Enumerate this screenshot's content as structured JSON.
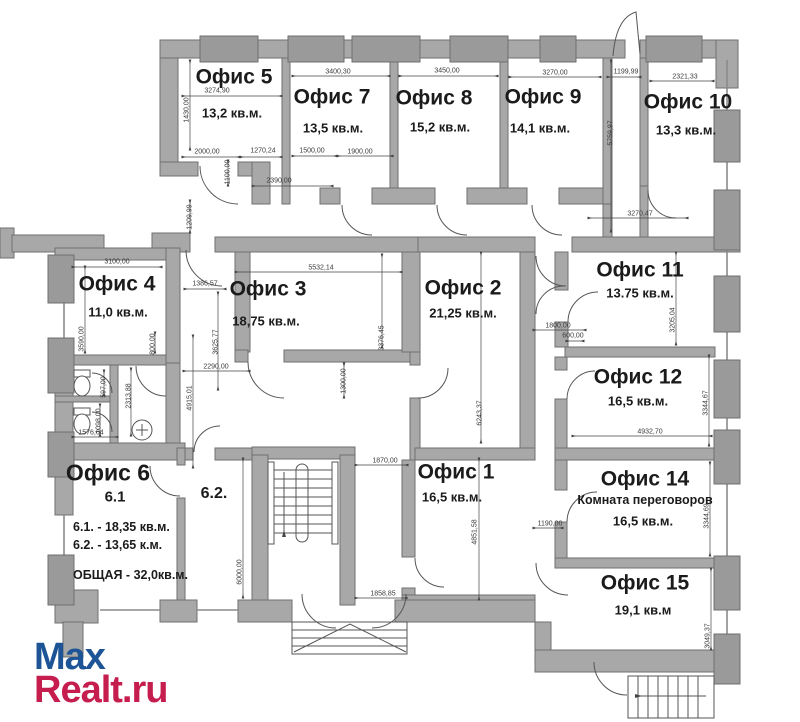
{
  "title": "Office floor plan",
  "watermark": {
    "line1": "Max",
    "line2": "Realt.ru"
  },
  "colors": {
    "wall": "#a8a8a8",
    "wall_outline": "#6f6f6f",
    "pier": "#9a9a9a",
    "line": "#444444",
    "watermark_blue": "#1d5496",
    "watermark_red": "#c51d4e"
  },
  "rooms": [
    {
      "name": "Офис 5",
      "area": "13,2 кв.м."
    },
    {
      "name": "Офис 7",
      "area": "13,5 кв.м."
    },
    {
      "name": "Офис 8",
      "area": "15,2 кв.м."
    },
    {
      "name": "Офис 9",
      "area": "14,1 кв.м."
    },
    {
      "name": "Офис 10",
      "area": "13,3 кв.м."
    },
    {
      "name": "Офис 4",
      "area": "11,0 кв.м."
    },
    {
      "name": "Офис 3",
      "area": "18,75 кв.м."
    },
    {
      "name": "Офис 2",
      "area": "21,25 кв.м."
    },
    {
      "name": "Офис 11",
      "area": "13.75 кв.м."
    },
    {
      "name": "Офис 12",
      "area": "16,5 кв.м."
    },
    {
      "name": "Офис 1",
      "area": "16,5 кв.м."
    },
    {
      "name": "Офис 14",
      "subtitle": "Комната переговоров",
      "area": "16,5 кв.м."
    },
    {
      "name": "Офис 15",
      "area": "19,1 кв.м"
    }
  ],
  "office6": {
    "name": "Офис 6",
    "part1_label": "6.1",
    "part2_label": "6.2.",
    "line1": "6.1. - 18,35 кв.м.",
    "line2": "6.2. - 13,65 к.м.",
    "total": "ОБЩАЯ - 32,0кв.м."
  },
  "dims": [
    "3274,90",
    "1430,00",
    "3400,30",
    "3450,00",
    "3270,00",
    "1199,99",
    "2321,33",
    "2000,00",
    "1270,24",
    "1500,00",
    "1900,00",
    "1100,00",
    "2390,00",
    "1209,99",
    "5759,97",
    "3270,47",
    "3100,00",
    "1386,57",
    "5532,14",
    "3590,00",
    "800,00",
    "3625,77",
    "3376,45",
    "2290,00",
    "4915,01",
    "1300,00",
    "6243,37",
    "597,00",
    "2313,88",
    "1098,00",
    "1576,64",
    "1800,00",
    "600,00",
    "3205,04",
    "4932,70",
    "3344,67",
    "1870,00",
    "4851,58",
    "1190,00",
    "3344,69",
    "6000,00",
    "1858,85",
    "3049,37"
  ]
}
